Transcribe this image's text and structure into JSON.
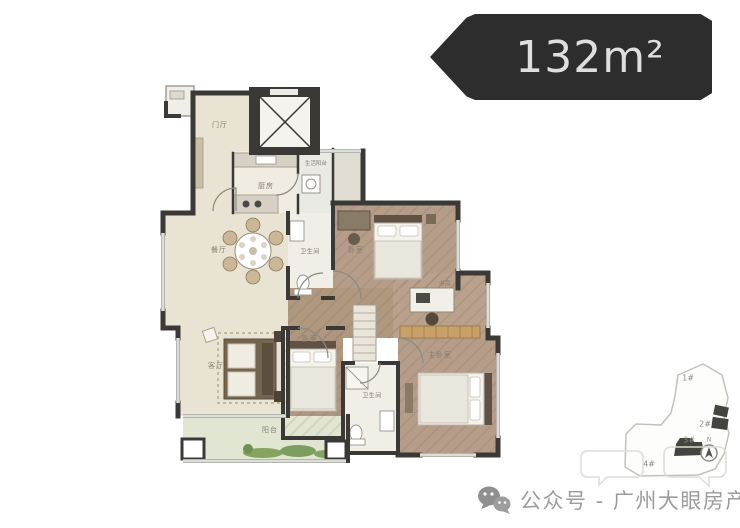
{
  "area_tag": {
    "label": "132m²"
  },
  "floorplan": {
    "rooms": [
      {
        "id": "foyer",
        "label": "门厅"
      },
      {
        "id": "kitchen",
        "label": "厨房"
      },
      {
        "id": "service-balcony",
        "label": "生活阳台"
      },
      {
        "id": "dining",
        "label": "餐厅"
      },
      {
        "id": "bath-1",
        "label": "卫生间"
      },
      {
        "id": "bedroom-2",
        "label": "卧室"
      },
      {
        "id": "study",
        "label": "书房"
      },
      {
        "id": "bedroom-3",
        "label": "卧室"
      },
      {
        "id": "bath-2",
        "label": "卫生间"
      },
      {
        "id": "master-bedroom",
        "label": "主卧室"
      },
      {
        "id": "living",
        "label": "客厅"
      },
      {
        "id": "balcony",
        "label": "阳台"
      }
    ]
  },
  "site_map": {
    "buildings": [
      {
        "label": "1#"
      },
      {
        "label": "2#"
      },
      {
        "label": "3#"
      },
      {
        "label": "4#"
      }
    ],
    "compass": "N"
  },
  "watermark": {
    "text": "公众号 - 广州大眼房产"
  },
  "colors": {
    "tag_bg": "#2d2d2d",
    "wall": "#3b3936",
    "wood_floor": "#b59d8a",
    "tile_floor": "#e9e3d4",
    "balcony_floor": "#e1e6d2",
    "wardrobe": "#c9a168",
    "greenery": "#7d9d5e"
  }
}
